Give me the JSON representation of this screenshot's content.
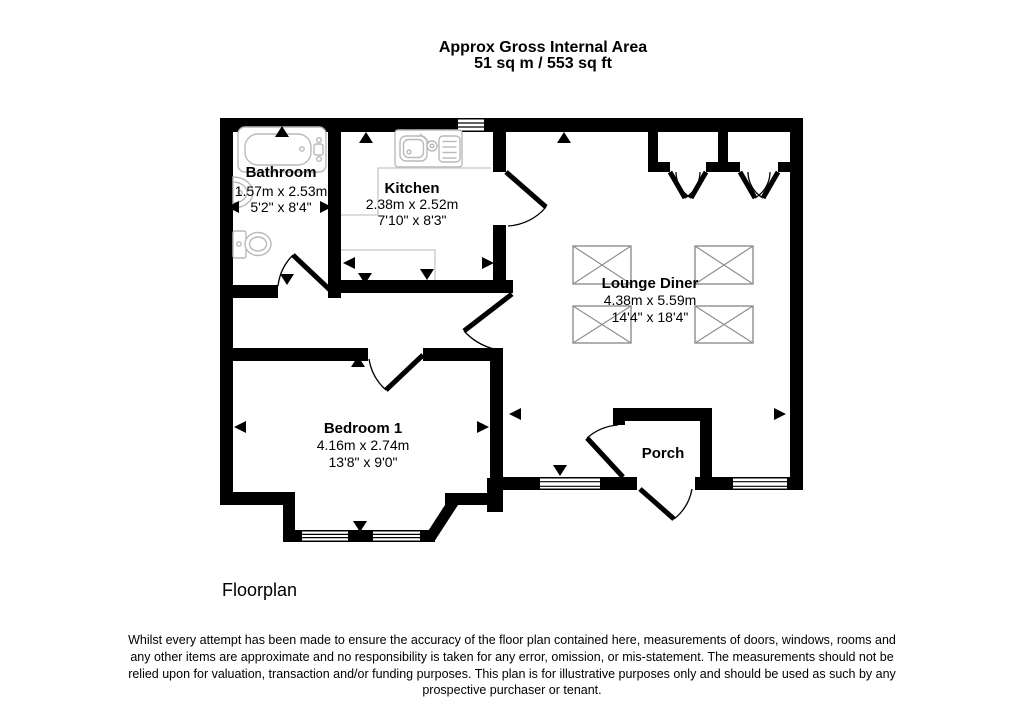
{
  "header": {
    "line1": "Approx Gross Internal Area",
    "line2": "51 sq m / 553 sq ft"
  },
  "rooms": {
    "bathroom": {
      "name": "Bathroom",
      "metric": "1.57m x 2.53m",
      "imperial": "5'2\" x 8'4\""
    },
    "kitchen": {
      "name": "Kitchen",
      "metric": "2.38m x 2.52m",
      "imperial": "7'10\" x 8'3\""
    },
    "lounge": {
      "name": "Lounge Diner",
      "metric": "4.38m x 5.59m",
      "imperial": "14'4\" x 18'4\""
    },
    "bedroom": {
      "name": "Bedroom 1",
      "metric": "4.16m x 2.74m",
      "imperial": "13'8\" x 9'0\""
    },
    "porch": {
      "name": "Porch"
    }
  },
  "caption": "Floorplan",
  "disclaimer": {
    "line1": "Whilst every attempt has been made to ensure the accuracy of the floor plan contained here, measurements of doors, windows, rooms and",
    "line2": "any other items are approximate and no responsibility is taken for any error, omission, or mis-statement. The measurements should not be",
    "line3": "relied upon for valuation, transaction and/or funding purposes. This plan is for illustrative purposes only and should be used as such by any",
    "line4": "prospective purchaser or tenant."
  },
  "colors": {
    "wall": "#000000",
    "fixture": "#b9b9b9",
    "skylight": "#8f8f8f",
    "background": "#ffffff"
  }
}
